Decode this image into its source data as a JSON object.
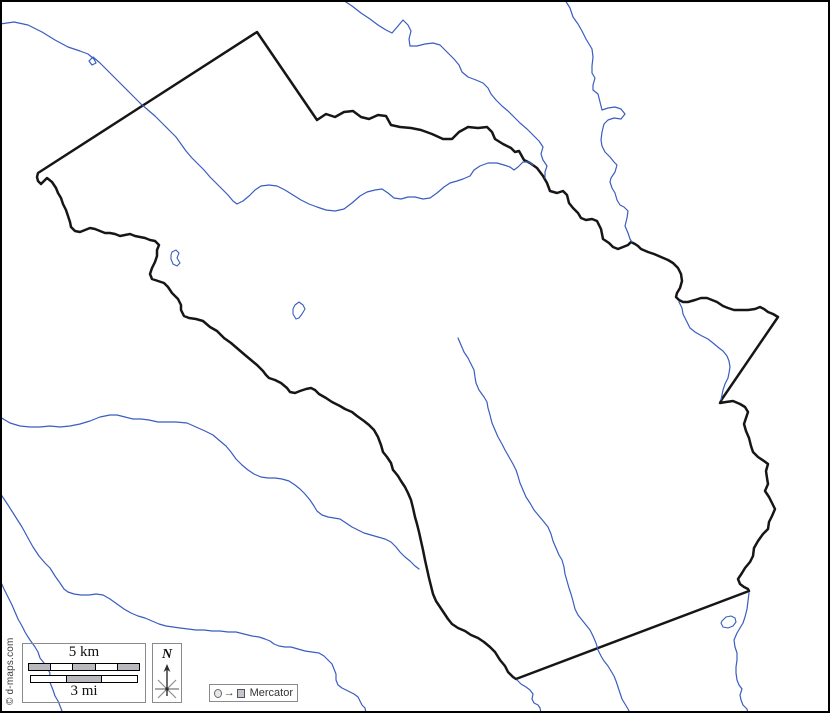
{
  "colors": {
    "frame": "#000000",
    "boundary": "#161616",
    "river": "#3a5dc0",
    "bar_gray": "#b9b9bf",
    "box_border": "#8a8a8a"
  },
  "footer": {
    "scale_km_label": "5 km",
    "scale_mi_label": "3 mi",
    "north_label": "N",
    "projection_label": "Mercator",
    "projection_arrow": "→",
    "copyright": "© d-maps.com"
  },
  "map": {
    "shapes": [
      {
        "name": "county-boundary",
        "type": "boundary",
        "closed": true,
        "points": "38,173 257,32 317,120 326,114 335,117 344,112 353,111 361,117 369,119 378,115 386,116 391,125 400,127 411,128 421,130 432,134 443,139 452,139 459,132 468,127 478,128 487,127 492,132 495,139 503,144 511,148 515,152 519,151 524,160 530,163 537,168 543,176 547,183 550,191 557,193 563,191 567,195 569,203 573,208 578,213 581,218 586,220 592,219 597,221 601,229 603,239 609,243 613,247 618,249 623,247 628,245 631,242 635,244 638,246 641,249 648,252 654,254 661,257 668,260 673,263 678,268 681,274 682,281 680,288 677,293 676,297 679,300 683,302 688,302 695,300 701,298 707,298 712,300 717,302 723,306 728,308 734,310 741,310 748,310 755,309 760,307 764,309 768,312 773,314 778,317 722,399 720,403 726,402 733,401 740,404 745,407 748,412 746,418 744,424 746,431 749,438 751,446 753,452 758,457 764,461 768,464 766,471 767,478 768,484 765,491 769,497 772,503 775,509 772,516 769,522 768,529 763,534 758,541 754,548 753,556 750,562 745,568 742,573 738,579 740,584 744,587 748,589 749,591 516,679 513,677 508,672 505,666 500,660 495,652 490,647 484,642 478,638 471,635 465,631 458,628 452,624 448,619 444,613 440,607 436,601 433,594 431,586 429,578 427,569 425,560 423,550 421,541 419,532 417,524 415,517 413,508 411,500 408,493 405,487 401,481 398,476 394,471 393,470 391,463 387,457 383,452 381,445 378,437 374,430 369,425 364,421 357,416 352,412 345,409 340,406 332,402 326,398 319,394 315,390 311,388 306,389 300,391 295,393 290,392 287,388 281,383 275,380 269,378 266,375 263,371 257,365 251,360 245,355 238,349 231,343 224,338 217,331 210,327 203,321 196,319 189,318 184,316 181,310 181,305 178,299 172,293 168,287 164,283 158,281 152,279 150,274 152,268 155,262 157,256 157,250 159,245 155,241 150,240 145,238 140,237 135,236 130,234 125,235 120,236 115,234 110,233 105,233 100,231 95,229 90,228 85,230 80,232 75,231 71,227 70,222 68,216 66,210 63,204 61,198 58,193 56,188 52,182 47,178 44,181 41,184 38,181 37,177"
      },
      {
        "name": "river-northwest",
        "type": "river",
        "closed": false,
        "points": "0,24 14,22 28,25 42,32 55,40 68,47 80,51 88,54 94,59 96,63 92,65 89,61 93,57 100,63 107,70 114,77 121,84 128,91 135,98 141,104 148,110 155,116 162,123 169,130 176,137 181,144 186,151 192,158 198,164 204,170 210,177 216,183 222,189 228,195 233,201 237,204 243,201 249,196 255,190 261,186 269,185 277,186 285,190 293,195 301,200 309,204 317,207 326,210 335,211 344,209 352,203 360,196 367,192 375,190 382,189 388,193 394,198 401,199 408,197 415,197 423,199 430,198 437,193 444,187 450,183 457,181 463,179 470,176 474,170 480,166 488,163 497,163 504,165 510,167 514,170 518,167 523,162 529,162 533,165"
      },
      {
        "name": "river-top-center",
        "type": "river",
        "closed": false,
        "points": "343,0 352,6 361,13 370,19 378,25 386,30 392,33 398,26 403,20 408,25 411,31 409,39 410,46 417,46 425,44 433,43 440,45 447,52 454,59 459,65 462,72 468,77 476,80 483,83 488,88 491,94 496,100 502,106 508,111 514,117 520,123 527,129 533,135 539,141 543,147 541,154 543,160 547,166 545,172 545,178"
      },
      {
        "name": "river-top-right",
        "type": "river",
        "closed": false,
        "points": "565,0 570,8 573,17 578,24 582,31 586,39 592,49 593,57 592,66 592,73 595,78 593,85 593,90 598,94 600,102 602,110 608,108 615,107 621,109 625,114 621,119 614,118 608,120 604,124 602,132 601,140 602,146 605,152 610,157 614,162 617,165 615,172 611,178 610,182 612,188 615,193 617,200 620,205 624,207 628,211 627,218 625,226 628,233 630,239 632,242"
      },
      {
        "name": "river-wedge",
        "type": "river",
        "closed": false,
        "points": "679,302 682,308 683,314 687,322 690,328 695,332 702,336 708,339 713,343 719,348 723,351 727,356 729,361 730,367 729,373 728,378 725,384 723,390 722,395 721,400"
      },
      {
        "name": "river-east",
        "type": "river",
        "closed": false,
        "points": "749,593 748,601 747,609 745,617 743,623 740,628 737,633 734,640 735,647 737,653 737,660 736,667 736,673 737,680 739,685 742,689 740,695 741,700 743,705 747,709 748,713"
      },
      {
        "name": "river-central",
        "type": "river",
        "closed": false,
        "points": "458,338 461,345 464,352 468,358 471,364 474,370 475,377 476,383 479,390 484,397 487,402 488,408 490,415 492,423 495,430 498,437 502,444 505,450 509,457 513,464 516,470 518,476 520,483 523,490 526,497 530,503 534,510 539,516 544,522 548,527 551,534 553,541 556,548 559,555 562,560 564,567 565,574 567,581 569,588 571,594 573,601 575,609 578,615 582,620 586,625 590,630 593,636 596,643 598,650 601,656 604,661 608,666 611,671 614,676 616,681 618,687 620,693 622,699 625,704 628,709 630,713"
      },
      {
        "name": "river-west-mid",
        "type": "river",
        "closed": false,
        "points": "0,417 10,423 20,426 30,427 40,427 50,426 60,427 70,426 80,424 90,421 100,417 110,415 117,415 125,417 133,419 141,419 149,420 158,422 167,422 176,422 187,423 196,427 205,431 213,435 220,441 226,446 231,452 236,459 242,465 248,470 254,474 261,477 268,478 275,478 282,479 289,481 295,485 300,489 305,494 310,500 314,506 317,511 322,515 328,517 334,518 340,519 346,523 352,527 358,530 364,533 371,535 378,537 385,539 391,542 396,547 400,552 405,557 410,561 415,566 419,569"
      },
      {
        "name": "river-southwest",
        "type": "river",
        "closed": false,
        "points": "0,493 8,505 15,516 22,527 28,538 33,547 39,556 45,563 50,568 55,576 60,583 64,589 68,592 74,594 81,595 89,595 96,594 103,595 110,599 117,604 124,609 131,613 138,616 145,618 152,621 159,624 166,626 173,627 180,628 188,629 196,630 204,630 212,631 220,631 228,632 236,632 244,634 252,636 259,637 265,639 270,641 274,644 279,646 285,647 291,647 298,649 305,651 312,652 319,653 324,656 328,660 332,664 334,669 336,674 336,680 338,685 342,688 348,691 354,694 358,697 360,701 362,705 365,708 366,713"
      },
      {
        "name": "river-scale-area",
        "type": "river",
        "closed": false,
        "points": "0,580 4,589 8,597 12,605 15,612 18,619 22,626 25,632 28,637 30,640 35,647 38,652 40,658 44,663 47,668 50,673 49,679 51,685 53,690 55,696 58,701 60,706 62,711 63,713"
      },
      {
        "name": "river-vertex-stub",
        "type": "river",
        "closed": false,
        "points": "517,680 521,684 526,687 530,690 533,694 532,699 534,703 538,705 540,708 541,713"
      },
      {
        "name": "lake-small-west",
        "type": "lake",
        "closed": true,
        "points": "172,252 176,250 179,253 177,258 180,263 177,266 173,264 171,259 171,255"
      },
      {
        "name": "lake-small-center",
        "type": "lake",
        "closed": true,
        "points": "295,305 299,302 303,305 305,309 302,314 299,318 296,319 293,314 293,309"
      },
      {
        "name": "lake-small-east",
        "type": "lake",
        "closed": true,
        "points": "722,621 726,617 731,616 735,618 736,622 733,626 728,628 723,627 721,623"
      }
    ]
  },
  "scale_bars": {
    "km_segments": [
      "g",
      "w",
      "g",
      "w",
      "g"
    ],
    "mi_segments": [
      "w",
      "g",
      "w"
    ]
  }
}
